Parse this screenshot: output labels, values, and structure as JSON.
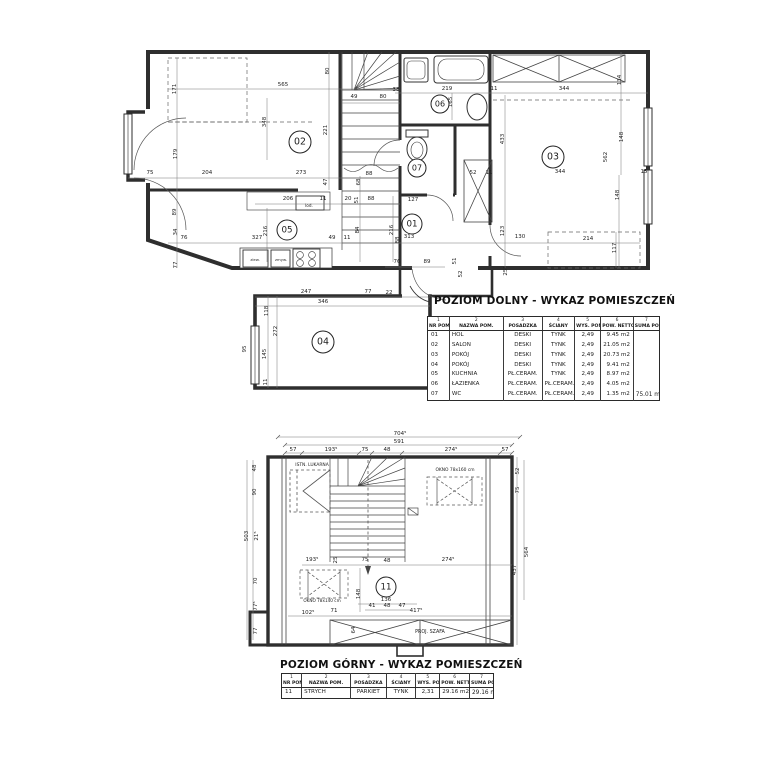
{
  "titles": {
    "lower": "POZIOM DOLNY - WYKAZ POMIESZCZEŃ",
    "upper": "POZIOM GÓRNY - WYKAZ POMIESZCZEŃ"
  },
  "tables": {
    "columns": [
      {
        "no": "1",
        "name": "NR POM."
      },
      {
        "no": "2",
        "name": "NAZWA POM."
      },
      {
        "no": "3",
        "name": "POSADZKA"
      },
      {
        "no": "4",
        "name": "ŚCIANY"
      },
      {
        "no": "5",
        "name": "WYS. POM."
      },
      {
        "no": "6",
        "name": "POW. NETTO"
      },
      {
        "no": "7",
        "name": "SUMA POW."
      }
    ],
    "lower": {
      "rows": [
        [
          "01",
          "HOL",
          "DESKI",
          "TYNK",
          "2,49",
          "9.45 m2"
        ],
        [
          "02",
          "SALON",
          "DESKI",
          "TYNK",
          "2,49",
          "21.05 m2"
        ],
        [
          "03",
          "POKÓJ",
          "DESKI",
          "TYNK",
          "2,49",
          "20.73 m2"
        ],
        [
          "04",
          "POKÓJ",
          "DESKI",
          "TYNK",
          "2,49",
          "9.41 m2"
        ],
        [
          "05",
          "KUCHNIA",
          "PŁ.CERAM.",
          "TYNK",
          "2,49",
          "8.97 m2"
        ],
        [
          "06",
          "ŁAZIENKA",
          "PŁ.CERAM.",
          "PŁ.CERAM.",
          "2,49",
          "4.05 m2"
        ],
        [
          "07",
          "WC",
          "PŁ.CERAM.",
          "PŁ.CERAM.",
          "2,49",
          "1.35 m2"
        ]
      ],
      "total": "75.01 m2"
    },
    "upper": {
      "rows": [
        [
          "11",
          "STRYCH",
          "PARKIET",
          "TYNK",
          "2,31",
          "29.16 m2"
        ]
      ],
      "total": "29.16 m2"
    }
  },
  "plan_lower": {
    "rooms": [
      {
        "t": "01",
        "x": 412,
        "y": 224,
        "cr": 10
      },
      {
        "t": "02",
        "x": 300,
        "y": 142,
        "cr": 11
      },
      {
        "t": "03",
        "x": 553,
        "y": 157,
        "cr": 11
      },
      {
        "t": "04",
        "x": 323,
        "y": 342,
        "cr": 11
      },
      {
        "t": "05",
        "x": 287,
        "y": 230,
        "cr": 10
      },
      {
        "t": "06",
        "x": 440,
        "y": 104,
        "cr": 9
      },
      {
        "t": "07",
        "x": 417,
        "y": 168,
        "cr": 9
      }
    ],
    "labels": [
      {
        "t": "171",
        "x": 176,
        "y": 89,
        "r": -90
      },
      {
        "t": "565",
        "x": 283,
        "y": 86
      },
      {
        "t": "348",
        "x": 266,
        "y": 122,
        "r": -90
      },
      {
        "t": "80",
        "x": 329,
        "y": 71,
        "r": -90
      },
      {
        "t": "49",
        "x": 354,
        "y": 98
      },
      {
        "t": "80",
        "x": 383,
        "y": 98
      },
      {
        "t": "221",
        "x": 327,
        "y": 130,
        "r": -90
      },
      {
        "t": "179",
        "x": 177,
        "y": 154,
        "r": -90
      },
      {
        "t": "38",
        "x": 396,
        "y": 91
      },
      {
        "t": "219",
        "x": 447,
        "y": 90
      },
      {
        "t": "11",
        "x": 494,
        "y": 90
      },
      {
        "t": "344",
        "x": 564,
        "y": 90
      },
      {
        "t": "134",
        "x": 621,
        "y": 80,
        "r": -90
      },
      {
        "t": "165",
        "x": 452,
        "y": 102,
        "r": -90
      },
      {
        "t": "433",
        "x": 504,
        "y": 139,
        "r": -90
      },
      {
        "t": "148",
        "x": 623,
        "y": 137,
        "r": -90
      },
      {
        "t": "562",
        "x": 607,
        "y": 157,
        "r": -90
      },
      {
        "t": "75",
        "x": 150,
        "y": 174
      },
      {
        "t": "204",
        "x": 207,
        "y": 174
      },
      {
        "t": "273",
        "x": 301,
        "y": 174
      },
      {
        "t": "88",
        "x": 369,
        "y": 175
      },
      {
        "t": "47",
        "x": 327,
        "y": 182,
        "r": -90
      },
      {
        "t": "68",
        "x": 360,
        "y": 182,
        "r": -90
      },
      {
        "t": "52",
        "x": 473,
        "y": 174
      },
      {
        "t": "11",
        "x": 489,
        "y": 174
      },
      {
        "t": "206",
        "x": 288,
        "y": 200
      },
      {
        "t": "11",
        "x": 323,
        "y": 200
      },
      {
        "t": "lod.",
        "x": 309,
        "y": 207,
        "s": 4.2
      },
      {
        "t": "20",
        "x": 348,
        "y": 200
      },
      {
        "t": "51",
        "x": 358,
        "y": 200,
        "r": -90
      },
      {
        "t": "88",
        "x": 371,
        "y": 200
      },
      {
        "t": "127",
        "x": 413,
        "y": 201
      },
      {
        "t": "89",
        "x": 176,
        "y": 212,
        "r": -90
      },
      {
        "t": "34",
        "x": 177,
        "y": 232,
        "r": -90
      },
      {
        "t": "76",
        "x": 184,
        "y": 239
      },
      {
        "t": "327",
        "x": 257,
        "y": 239
      },
      {
        "t": "216",
        "x": 267,
        "y": 231,
        "r": -90
      },
      {
        "t": "49",
        "x": 332,
        "y": 239
      },
      {
        "t": "11",
        "x": 347,
        "y": 239
      },
      {
        "t": "84",
        "x": 359,
        "y": 230,
        "r": -90
      },
      {
        "t": "77",
        "x": 177,
        "y": 265,
        "r": -90
      },
      {
        "t": "216",
        "x": 393,
        "y": 230,
        "r": -90
      },
      {
        "t": "88",
        "x": 399,
        "y": 240,
        "r": -90
      },
      {
        "t": "313",
        "x": 409,
        "y": 238
      },
      {
        "t": "123",
        "x": 504,
        "y": 231,
        "r": -90
      },
      {
        "t": "130",
        "x": 520,
        "y": 238
      },
      {
        "t": "344",
        "x": 560,
        "y": 173
      },
      {
        "t": "15",
        "x": 644,
        "y": 173
      },
      {
        "t": "148",
        "x": 619,
        "y": 195,
        "r": -90
      },
      {
        "t": "214",
        "x": 588,
        "y": 240
      },
      {
        "t": "117",
        "x": 616,
        "y": 248,
        "r": -90
      },
      {
        "t": "51",
        "x": 456,
        "y": 261,
        "r": -90
      },
      {
        "t": "52",
        "x": 462,
        "y": 274,
        "r": -90
      },
      {
        "t": "76",
        "x": 397,
        "y": 263
      },
      {
        "t": "89",
        "x": 427,
        "y": 263
      },
      {
        "t": "25⁵",
        "x": 507,
        "y": 271,
        "r": -90
      },
      {
        "t": "247",
        "x": 306,
        "y": 293
      },
      {
        "t": "77",
        "x": 368,
        "y": 293
      },
      {
        "t": "22",
        "x": 389,
        "y": 294
      },
      {
        "t": "346",
        "x": 323,
        "y": 303
      },
      {
        "t": "118",
        "x": 268,
        "y": 311,
        "r": -90
      },
      {
        "t": "272",
        "x": 277,
        "y": 331,
        "r": -90
      },
      {
        "t": "145",
        "x": 266,
        "y": 354,
        "r": -90
      },
      {
        "t": "11",
        "x": 267,
        "y": 382,
        "r": -90
      },
      {
        "t": "95",
        "x": 246,
        "y": 349,
        "r": -90
      },
      {
        "t": "zlew.",
        "x": 255,
        "y": 261,
        "s": 3.8
      },
      {
        "t": "zmyw.",
        "x": 281,
        "y": 261,
        "s": 3.8
      }
    ]
  },
  "plan_upper": {
    "rooms": [
      {
        "t": "11",
        "x": 386,
        "y": 587,
        "cr": 10
      }
    ],
    "labels": [
      {
        "t": "704⁵",
        "x": 400,
        "y": 435
      },
      {
        "t": "591",
        "x": 399,
        "y": 443
      },
      {
        "t": "57",
        "x": 293,
        "y": 451
      },
      {
        "t": "193⁵",
        "x": 331,
        "y": 451
      },
      {
        "t": "75",
        "x": 365,
        "y": 451
      },
      {
        "t": "48",
        "x": 387,
        "y": 451
      },
      {
        "t": "274⁵",
        "x": 451,
        "y": 451
      },
      {
        "t": "57",
        "x": 505,
        "y": 451
      },
      {
        "t": "48",
        "x": 256,
        "y": 468,
        "r": -90
      },
      {
        "t": "90",
        "x": 256,
        "y": 492,
        "r": -90
      },
      {
        "t": "503",
        "x": 248,
        "y": 536,
        "r": -90
      },
      {
        "t": "21⁵",
        "x": 258,
        "y": 536,
        "r": -90
      },
      {
        "t": "70",
        "x": 257,
        "y": 581,
        "r": -90
      },
      {
        "t": "77⁵",
        "x": 257,
        "y": 606,
        "r": -90
      },
      {
        "t": "77",
        "x": 257,
        "y": 631,
        "r": -90
      },
      {
        "t": "52",
        "x": 519,
        "y": 471,
        "r": -90
      },
      {
        "t": "75",
        "x": 519,
        "y": 490,
        "r": -90
      },
      {
        "t": "564",
        "x": 528,
        "y": 552,
        "r": -90
      },
      {
        "t": "437",
        "x": 516,
        "y": 570,
        "r": -90
      },
      {
        "t": "ISTN. LUKARNA",
        "x": 312,
        "y": 466,
        "s": 4.4
      },
      {
        "t": "OKNO 78x160 cm",
        "x": 455,
        "y": 471,
        "s": 4.4
      },
      {
        "t": "25",
        "x": 337,
        "y": 560,
        "r": -90
      },
      {
        "t": "193⁵",
        "x": 312,
        "y": 561
      },
      {
        "t": "75",
        "x": 365,
        "y": 561
      },
      {
        "t": "48",
        "x": 387,
        "y": 562
      },
      {
        "t": "274⁵",
        "x": 448,
        "y": 561
      },
      {
        "t": "148",
        "x": 360,
        "y": 594,
        "r": -90
      },
      {
        "t": "136",
        "x": 386,
        "y": 601
      },
      {
        "t": "41",
        "x": 372,
        "y": 607
      },
      {
        "t": "48",
        "x": 387,
        "y": 607
      },
      {
        "t": "47",
        "x": 402,
        "y": 607
      },
      {
        "t": "417⁵",
        "x": 416,
        "y": 612
      },
      {
        "t": "102⁵",
        "x": 308,
        "y": 614
      },
      {
        "t": "71",
        "x": 334,
        "y": 612
      },
      {
        "t": "OKNO 78x140 cm",
        "x": 322,
        "y": 602,
        "s": 4.2
      },
      {
        "t": "64",
        "x": 355,
        "y": 630,
        "r": -90
      },
      {
        "t": "PROJ. SZAFA",
        "x": 430,
        "y": 633,
        "s": 4.8
      }
    ]
  }
}
